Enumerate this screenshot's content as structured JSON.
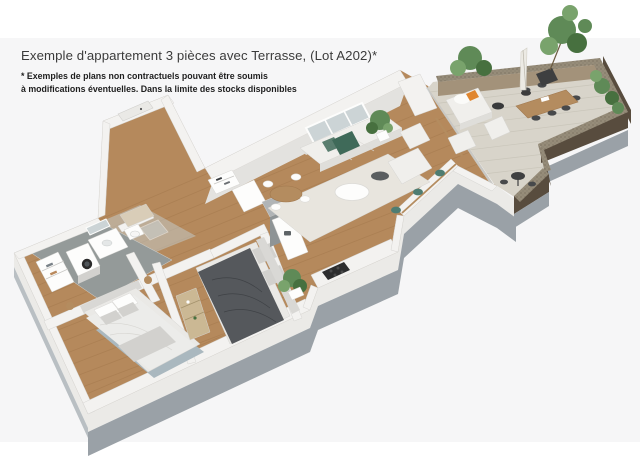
{
  "header": {
    "title": "Exemple d'appartement 3 pièces avec Terrasse, (Lot A202)*",
    "disclaimer_line1": "* Exemples de plans non contractuels pouvant être soumis",
    "disclaimer_line2": "à modifications éventuelles. Dans la limite des stocks disponibles"
  },
  "floorplan": {
    "type": "3d-isometric-floor-plan",
    "lot": "A202",
    "rooms": [
      {
        "id": "entrance-hall",
        "furniture": [
          "entry-door",
          "doormat",
          "shoe-shelf"
        ]
      },
      {
        "id": "bathroom-laundry",
        "furniture": [
          "washing-machine",
          "linen-shelves",
          "vanity-sink",
          "mirror",
          "toilet",
          "shower"
        ]
      },
      {
        "id": "bedroom-1",
        "furniture": [
          "double-bed",
          "pillows",
          "area-rug",
          "nightstand-left",
          "nightstand-right"
        ]
      },
      {
        "id": "bedroom-2",
        "furniture": [
          "double-bed-dark",
          "headboard",
          "bookshelf"
        ]
      },
      {
        "id": "kitchen",
        "furniture": [
          "island-unit",
          "fridge",
          "counter",
          "cooktop",
          "sink",
          "plant"
        ]
      },
      {
        "id": "living-dining",
        "furniture": [
          "sofa",
          "green-throw",
          "coffee-table",
          "side-table",
          "chaise",
          "armchair",
          "round-dining-table",
          "dining-chairs",
          "bar-counter",
          "bar-stools",
          "rug",
          "plant",
          "window",
          "sliding-glass-door"
        ]
      },
      {
        "id": "terrace",
        "furniture": [
          "outdoor-sofa",
          "orange-cushion",
          "side-table-dark",
          "lounge-chair-1",
          "lounge-chair-2",
          "outdoor-dining-table",
          "outdoor-chairs",
          "parasol",
          "planter-tree",
          "bistro-table",
          "bistro-chairs",
          "railing-planting"
        ]
      }
    ],
    "colors": {
      "photoBg": "#f6f6f7",
      "ink": "#3b3b3b",
      "inkSoft": "#1e1e1e",
      "edge": "#d6d5d2",
      "wall": "#f3f2f0",
      "wallShade": "#e3e2df",
      "wallFace": "#ebeae7",
      "slab": "#9aa1a7",
      "slabLight": "#b9bfc3",
      "wood": "#b5895c",
      "woodLine": "#9c7146",
      "tile": "#949a99",
      "tileLight": "#c3c8c6",
      "deck": "#d8d4ca",
      "deckLine": "#c6c2b6",
      "railTop": "#968c79",
      "railInner": "#a3927a",
      "railOuter": "#584c3e",
      "rug": "#e8e5de",
      "rugBlue": "#aab8bf",
      "sofa": "#f0efec",
      "sofaShade": "#dfdeda",
      "bedLight": "#eae9e6",
      "bedShade": "#d2d1ce",
      "duvet": "#55585c",
      "headboard": "#d9d8d5",
      "green": "#3f6a59",
      "teal": "#4e7d72",
      "plant": "#5f8a57",
      "plantDark": "#47703f",
      "plantLight": "#79a36c",
      "woodFurn": "#b48c5f",
      "chairDark": "#47494b",
      "orange": "#e0862f",
      "appliance": "#b0b4b6",
      "applianceDark": "#8e9496",
      "glass": "#ccd4d6",
      "mat": "#d9cdb8",
      "shelf": "#cbb894"
    }
  }
}
